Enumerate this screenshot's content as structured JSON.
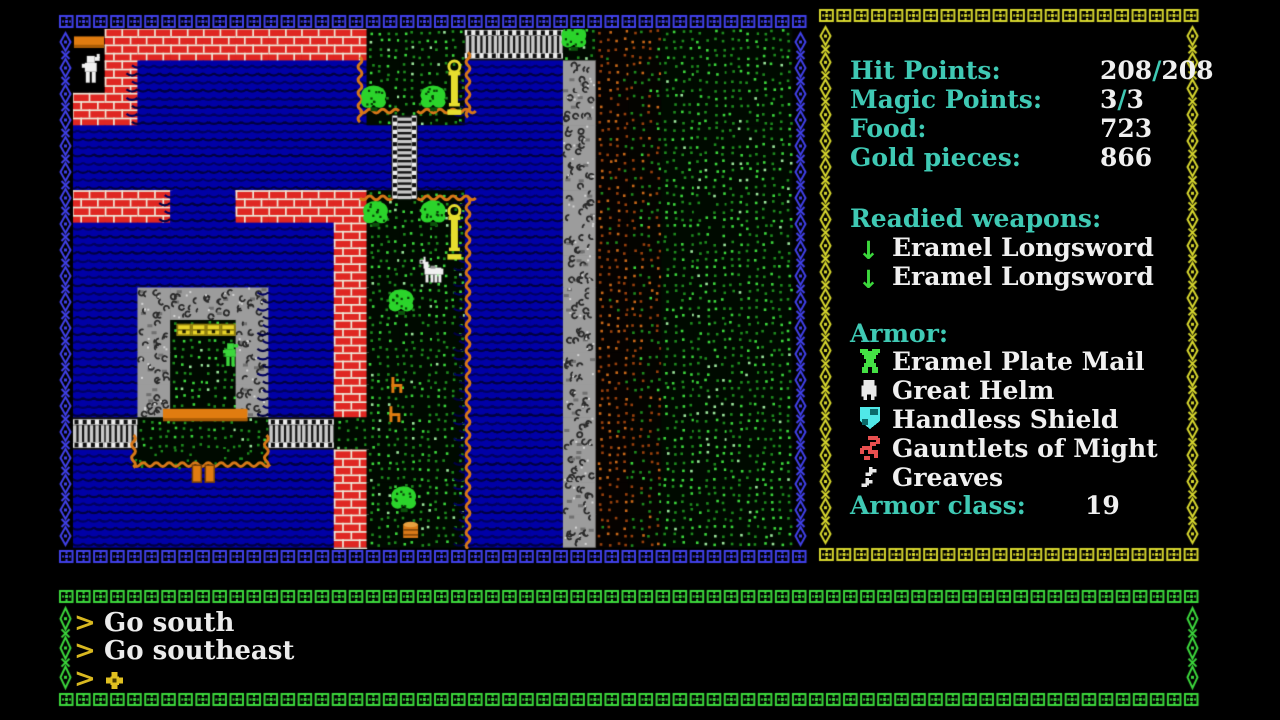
{
  "colors": {
    "label": "#3FC9B4",
    "value": "#F0F0F0",
    "prompt": "#D8B820",
    "weapon_arrow": "#3CD83C",
    "border_blue": "#4040E8",
    "border_yellow": "#D6D62E",
    "border_green": "#3CD83C",
    "water_bg": "#0000A6",
    "water_wave": "#000042",
    "water_wave2": "#2E2ED8",
    "grass_bg": "#000A00",
    "grass_dot_dim": "#1E8C1E",
    "grass_dot_bright": "#3CD83C",
    "grass_dot_pale": "#9CE89C",
    "field_dot_dark": "#98400C",
    "field_dot_light": "#C86818",
    "brick": "#DF2722",
    "mortar": "#EFE7D7",
    "rock": "#9C9C9C",
    "rock_dark": "#2A2A2A",
    "rock_light": "#D6D6D6",
    "bridge_dark": "#141414",
    "bridge_light": "#C8C8C8",
    "bridge_rail": "#EDEDED",
    "orange": "#E07C10",
    "shore_orange": "#D87818",
    "tree_green": "#2BD42B",
    "tree_dark": "#063F06",
    "lamp_yellow": "#E6DE2E",
    "chest_yellow": "#E8D428",
    "sprite_white": "#F0F0F0",
    "npc_green": "#3CD83C"
  },
  "map": {
    "origin": {
      "x": 72,
      "y": 28
    },
    "tile_w": 32.727,
    "tile_h": 32.4375,
    "box": {
      "x": 58,
      "y": 14,
      "w": 750,
      "h": 550
    },
    "legend": {
      "W": "water",
      "B": "brick-wall",
      "G": "grass",
      "R": "rock-wall",
      "F": "plowed-field",
      "f": "field-edge",
      "K": "building-interior",
      "H": "bridge"
    },
    "rows": [
      "KBBBBBBBBGGGHHHGFfGGGG",
      "KBWWWWWWWGGGWWWRFfGGGG",
      "BBWWWWWWWGGGWWWRFfGGGG",
      "WWWWWWWWWWWWWWWRFfGGGG",
      "WWWWWWWWWWWWWWWRFfGGGG",
      "BBBWWBBBBGGGWWWRFfGGGG",
      "WWWWWWWWBGGGWWWRFfGGGG",
      "WWWWWWWWBGGGWWWRFfGGGG",
      "WWRRRRWWBGGGWWWRFfGGGG",
      "WWRGGRWWBGGGWWWRFfGGGG",
      "WWRGGRWWBGGGWWWRFfGGGG",
      "WWRGGRWWBGGGWWWRFfGGGG",
      "HHGGGGHHGGGGWWWRFfGGGG",
      "WWWWWWWWBGGGWWWRFfGGGG",
      "WWWWWWWWBGGGWWWRFfGGGG",
      "WWWWWWWWBGGGWWWRFfGGGG"
    ],
    "sprites": [
      {
        "type": "grasspatch",
        "col": 1.85,
        "row": 12.98,
        "w": 4.15,
        "h": 0.58
      },
      {
        "type": "wavev",
        "col": 12.1,
        "row": 0.75,
        "len": 2.0
      },
      {
        "type": "wavev",
        "col": 8.8,
        "row": 0.9,
        "len": 1.82
      },
      {
        "type": "waveh",
        "col": 8.8,
        "row": 2.56,
        "len": 1.0
      },
      {
        "type": "waveh",
        "col": 10.55,
        "row": 2.56,
        "len": 1.62
      },
      {
        "type": "waveh",
        "col": 8.8,
        "row": 5.24,
        "len": 1.0
      },
      {
        "type": "waveh",
        "col": 10.55,
        "row": 5.24,
        "len": 1.62
      },
      {
        "type": "wavev",
        "col": 12.1,
        "row": 5.24,
        "len": 10.7
      },
      {
        "type": "wavev",
        "col": 1.88,
        "row": 12.55,
        "len": 1.0
      },
      {
        "type": "wavev",
        "col": 5.94,
        "row": 12.55,
        "len": 1.0
      },
      {
        "type": "waveh",
        "col": 1.88,
        "row": 13.46,
        "len": 4.08
      },
      {
        "type": "bridgev",
        "col": 9.76,
        "row": 2.7,
        "w": 0.8,
        "h": 2.56
      },
      {
        "type": "counter",
        "col": 0.06,
        "row": 0.26,
        "w": 0.92,
        "h": 0.35
      },
      {
        "type": "table",
        "col": 2.78,
        "row": 11.74,
        "w": 2.58,
        "h": 0.38
      },
      {
        "type": "chest",
        "col": 3.2,
        "row": 9.06
      },
      {
        "type": "chest",
        "col": 3.65,
        "row": 9.06
      },
      {
        "type": "chest",
        "col": 4.1,
        "row": 9.06
      },
      {
        "type": "chest",
        "col": 4.55,
        "row": 9.06
      },
      {
        "type": "dock",
        "col": 3.68,
        "row": 13.48
      },
      {
        "type": "chair",
        "col": 9.76,
        "row": 10.76
      },
      {
        "type": "chair",
        "col": 9.7,
        "row": 11.66
      },
      {
        "type": "barrel",
        "col": 10.12,
        "row": 15.2
      },
      {
        "type": "tree",
        "col": 8.82,
        "row": 1.74
      },
      {
        "type": "tree",
        "col": 10.64,
        "row": 1.74
      },
      {
        "type": "tree",
        "col": 8.88,
        "row": 5.3
      },
      {
        "type": "tree",
        "col": 10.64,
        "row": 5.28
      },
      {
        "type": "tree",
        "col": 9.66,
        "row": 8.02
      },
      {
        "type": "tree",
        "col": 9.74,
        "row": 14.1
      },
      {
        "type": "tree",
        "col": 14.94,
        "row": -0.12
      },
      {
        "type": "lamp",
        "col": 11.44,
        "row": 1.0
      },
      {
        "type": "lamp",
        "col": 11.44,
        "row": 5.46
      },
      {
        "type": "horse",
        "col": 10.62,
        "row": 7.02
      },
      {
        "type": "npc",
        "col": 4.56,
        "row": 9.72
      },
      {
        "type": "player",
        "col": 0.24,
        "row": 0.86
      }
    ]
  },
  "panels": {
    "stats_box": {
      "x": 818,
      "y": 8,
      "w": 382,
      "h": 554
    },
    "command_box": {
      "x": 58,
      "y": 589,
      "w": 1142,
      "h": 118
    }
  },
  "stats_panel": {
    "rows": [
      {
        "label": "Hit Points:",
        "value": "208/208"
      },
      {
        "label": "Magic Points:",
        "value": "3/3"
      },
      {
        "label": "Food:",
        "value": "723"
      },
      {
        "label": "Gold pieces:",
        "value": "866"
      }
    ],
    "weapons_header": "Readied weapons:",
    "weapons": [
      {
        "icon": "down-arrow",
        "name": "Eramel Longsword"
      },
      {
        "icon": "down-arrow",
        "name": "Eramel Longsword"
      }
    ],
    "armor_header": "Armor:",
    "armor": [
      {
        "icon": "plate-mail",
        "name": "Eramel Plate Mail"
      },
      {
        "icon": "helm",
        "name": "Great Helm"
      },
      {
        "icon": "shield",
        "name": "Handless Shield"
      },
      {
        "icon": "gauntlet",
        "name": "Gauntlets of Might"
      },
      {
        "icon": "greaves",
        "name": "Greaves"
      }
    ],
    "armor_class_label": "Armor class:",
    "armor_class_value": "19",
    "arrow_glyph": "↓"
  },
  "command_log": {
    "prompt_char": ">",
    "entries": [
      "Go south",
      "Go southeast"
    ]
  }
}
